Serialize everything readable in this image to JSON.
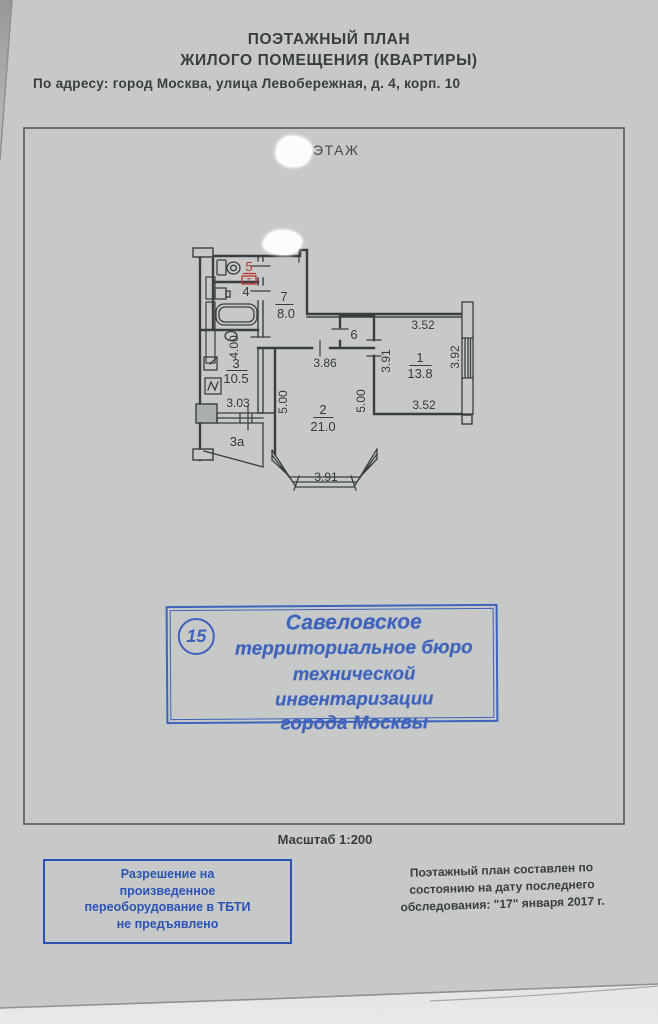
{
  "document": {
    "title_line1": "ПОЭТАЖНЫЙ ПЛАН",
    "title_line2": "ЖИЛОГО ПОМЕЩЕНИЯ (КВАРТИРЫ)",
    "address": "По адресу: город Москва, улица Левобережная, д. 4, корп. 10",
    "floor_label": "ЭТАЖ",
    "scale": "Масштаб 1:200"
  },
  "plan": {
    "rooms": {
      "r1_no": "1",
      "r1_area": "13.8",
      "r2_no": "2",
      "r2_area": "21.0",
      "r3_no": "3",
      "r3_area": "10.5",
      "r3a": "3а",
      "r4": "4",
      "r5": "5",
      "r5_mark": "Т",
      "r6": "6",
      "r7_no": "7",
      "r7_area": "8.0"
    },
    "dims": {
      "d400": "4.00",
      "d303": "3.03",
      "d386": "3.86",
      "d500_left": "5.00",
      "d500_right": "5.00",
      "d391_bay": "3.91",
      "d391_room1": "3.91",
      "d392": "3.92",
      "d352_top": "3.52",
      "d352_bottom": "3.52"
    }
  },
  "stamp": {
    "number": "15",
    "lines": [
      "Савеловское",
      "территориальное бюро",
      "технической инвентаризации",
      "города Москвы"
    ]
  },
  "permission_box": {
    "lines": [
      "Разрешение на",
      "произведенное",
      "переоборудование в ТБТИ",
      "не предъявлено"
    ]
  },
  "survey_note": {
    "lines": [
      "Поэтажный план составлен по",
      "состоянию на дату последнего",
      "обследования: \"17\" января 2017 г."
    ]
  },
  "colors": {
    "paper": "#c6c9c8",
    "ink": "#3b3e41",
    "stamp_blue": "#3f63bd",
    "red": "#bf3430"
  }
}
